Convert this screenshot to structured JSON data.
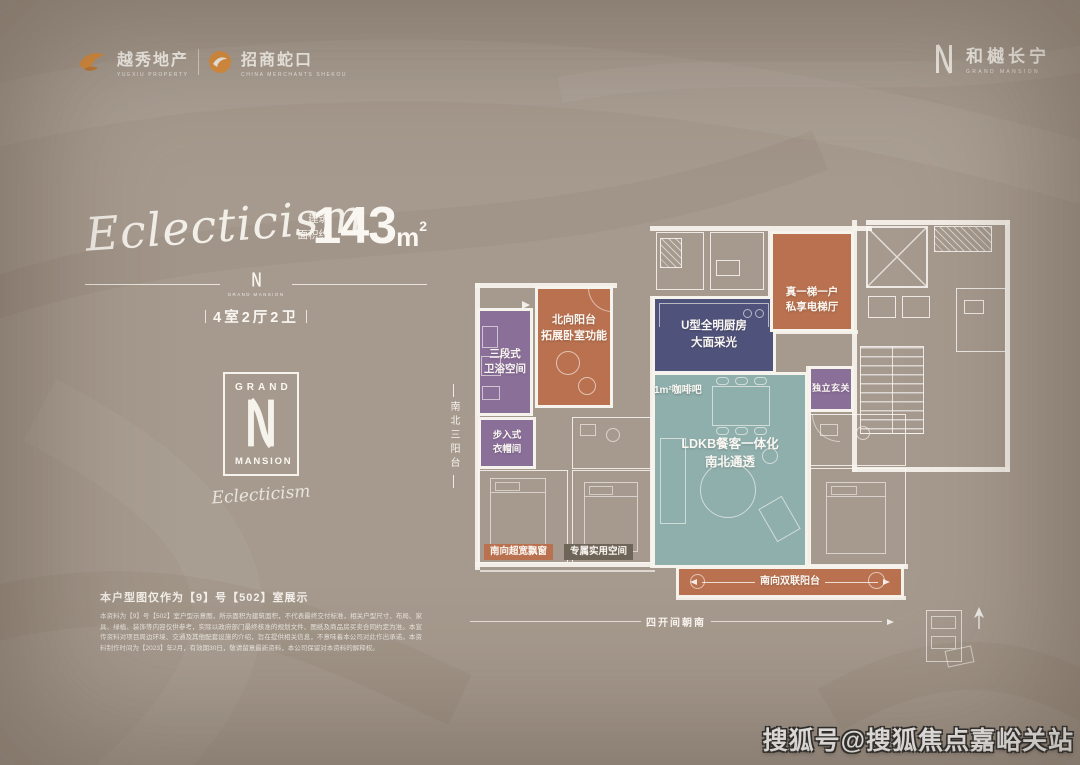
{
  "colors": {
    "bg": "#a69a8e",
    "wall": "#f6f2ec",
    "terracotta": "#b9714f",
    "purple": "#8a6f99",
    "indigo": "#4f527a",
    "teal": "#8fafac",
    "chipdark": "#6e6458",
    "brandorange": "#dd8f3e"
  },
  "header": {
    "yuexiu_cn": "越秀地产",
    "yuexiu_en": "YUEXIU PROPERTY",
    "cmsk_cn": "招商蛇口",
    "cmsk_en": "CHINA MERCHANTS SHEKOU",
    "brand_cn": "和樾长宁",
    "brand_en": "GRAND MANSION"
  },
  "hero": {
    "script": "Eclecticism",
    "area_label_1": "建筑",
    "area_label_2": "面积约",
    "area_value": "143",
    "area_unit": "m",
    "area_sup": "2",
    "divider_brand": "GRAND MANSION",
    "layout": "4室2厅2卫"
  },
  "brand_box": {
    "grand": "GRAND",
    "mansion": "MANSION",
    "signature": "Eclecticism"
  },
  "floorplan": {
    "bath_l1": "三段式",
    "bath_l2": "卫浴空间",
    "nbal_l1": "北向阳台",
    "nbal_l2": "拓展卧室功能",
    "kitchen_l1": "U型全明厨房",
    "kitchen_l2": "大面采光",
    "ldk_l1": "LDKB餐客一体化",
    "ldk_l2": "南北通透",
    "coffee": "1m²咖啡吧",
    "foyer": "独立玄关",
    "closet_l1": "步入式",
    "closet_l2": "衣帽间",
    "lift_l1": "真一梯一户",
    "lift_l2": "私享电梯厅",
    "sbal": "南向双联阳台",
    "chip_bay": "南向超宽飘窗",
    "chip_space": "专属实用空间",
    "side_note": "南北三阳台",
    "bottom_note": "四开间朝南"
  },
  "footer": {
    "note": "本户型图仅作为【9】号【502】室展示",
    "disclaimer": "本资料为【9】号【502】室户型示意图，所示面积为建筑面积，不代表最终交付标准，相关户型尺寸、布局、家具、绿植、装饰等内容仅供参考，实际以政府部门最终核准的规划文件、图纸及商品房买卖合同约定为准。本宣传资料对项目周边环境、交通及其他配套设施的介绍，旨在提供相关信息，不意味着本公司对此作出承诺。本资料制作时间为【2023】年2月，有效期30日，敬请留意最新资料，本公司保留对本资料的解释权。"
  },
  "watermark": "搜狐号@搜狐焦点嘉峪关站"
}
